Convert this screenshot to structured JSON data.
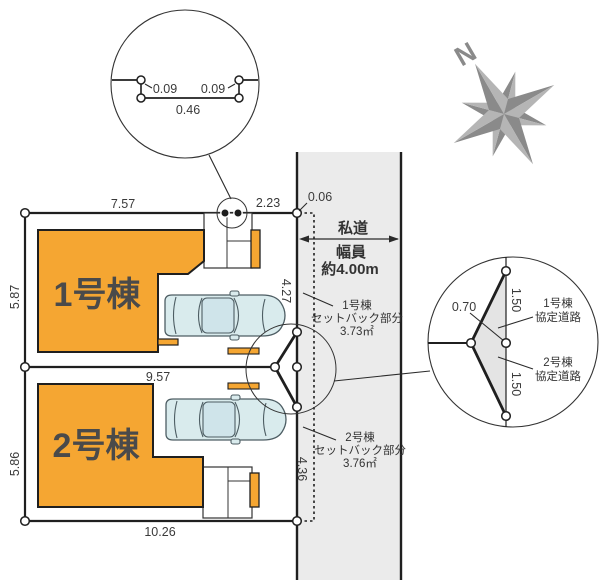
{
  "detail_top": {
    "offset_left": "0.09",
    "offset_right": "0.09",
    "span": "0.46"
  },
  "compass": {
    "north": "N"
  },
  "plan": {
    "lot1_label": "1号棟",
    "lot2_label": "2号棟",
    "dims": {
      "lot1_top": "7.57",
      "lot1_top_right": "2.23",
      "lot1_left": "5.87",
      "lot1_right": "4.27",
      "divider": "9.57",
      "lot2_left": "5.86",
      "lot2_right": "4.36",
      "lot2_bottom": "10.26",
      "corner_offset": "0.06"
    },
    "road": {
      "name": "私道",
      "width_label": "幅員",
      "width_value": "約4.00m"
    },
    "setback1": {
      "l1": "1号棟",
      "l2": "セットバック部分",
      "l3": "3.73㎡"
    },
    "setback2": {
      "l1": "2号棟",
      "l2": "セットバック部分",
      "l3": "3.76㎡"
    }
  },
  "detail_right": {
    "offset": "0.70",
    "seg_upper": "1.50",
    "seg_lower": "1.50",
    "road1_l1": "1号棟",
    "road1_l2": "協定道路",
    "road2_l1": "2号棟",
    "road2_l2": "協定道路"
  },
  "colors": {
    "building": "#F5A632",
    "road_fill": "#EBEBEB",
    "car_body": "#D9EBED",
    "car_roof": "#CFE4EA",
    "compass_dark": "#8A8A8A",
    "compass_light": "#B5B5B5",
    "triangle_fill": "#E4E4E4",
    "line": "#1F1F1F"
  }
}
